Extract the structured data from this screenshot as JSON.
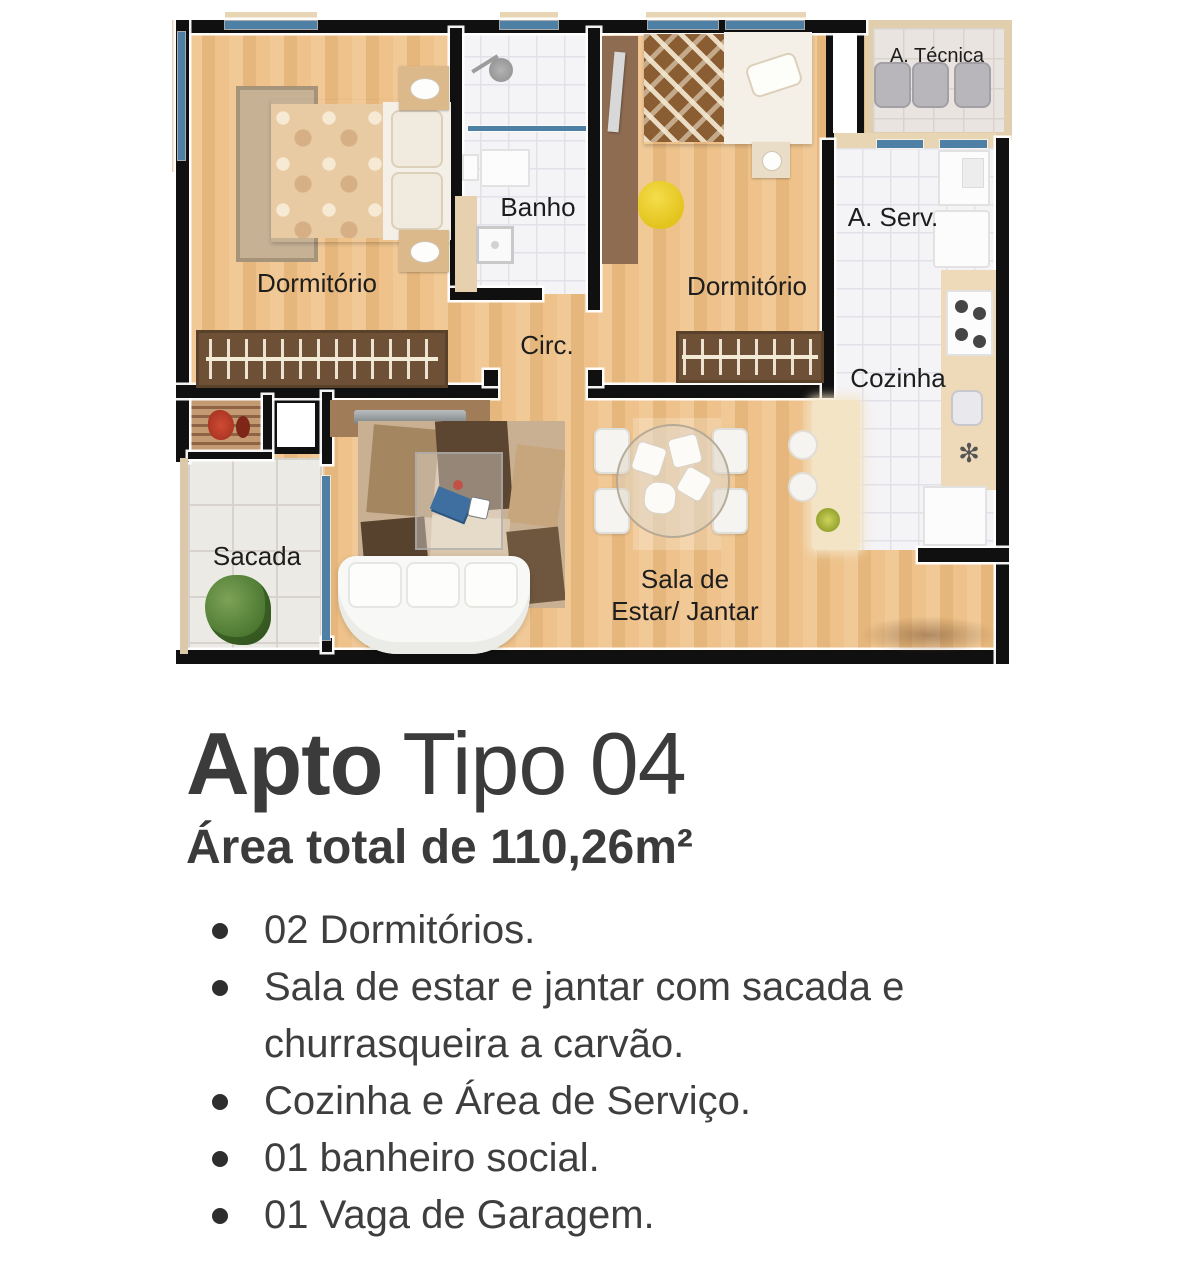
{
  "plan": {
    "rooms": {
      "dorm1": "Dormitório",
      "banho": "Banho",
      "circ": "Circ.",
      "dorm2": "Dormitório",
      "atecnica": "A. Técnica",
      "aserv": "A. Serv.",
      "cozinha": "Cozinha",
      "sacada": "Sacada",
      "sala_line1": "Sala de",
      "sala_line2": "Estar/ Jantar"
    },
    "colors": {
      "wall": "#101010",
      "wood_floor": "#ecc089",
      "tile_floor": "#f4f3f6",
      "window_glass": "#4e80a6",
      "wardrobe_brown": "#6e5036",
      "counter_beige": "#eed9b9",
      "accent_yellow": "#efd32c",
      "plant_green": "#4e7a33",
      "text_dark": "#3b3b3b"
    }
  },
  "info": {
    "title_bold": "Apto",
    "title_light": "Tipo 04",
    "subtitle": "Área total de 110,26m²",
    "features": [
      "02 Dormitórios.",
      "Sala de estar e jantar com sacada e churrasqueira a carvão.",
      "Cozinha e Área de Serviço.",
      "01 banheiro social.",
      "01 Vaga de Garagem."
    ]
  }
}
